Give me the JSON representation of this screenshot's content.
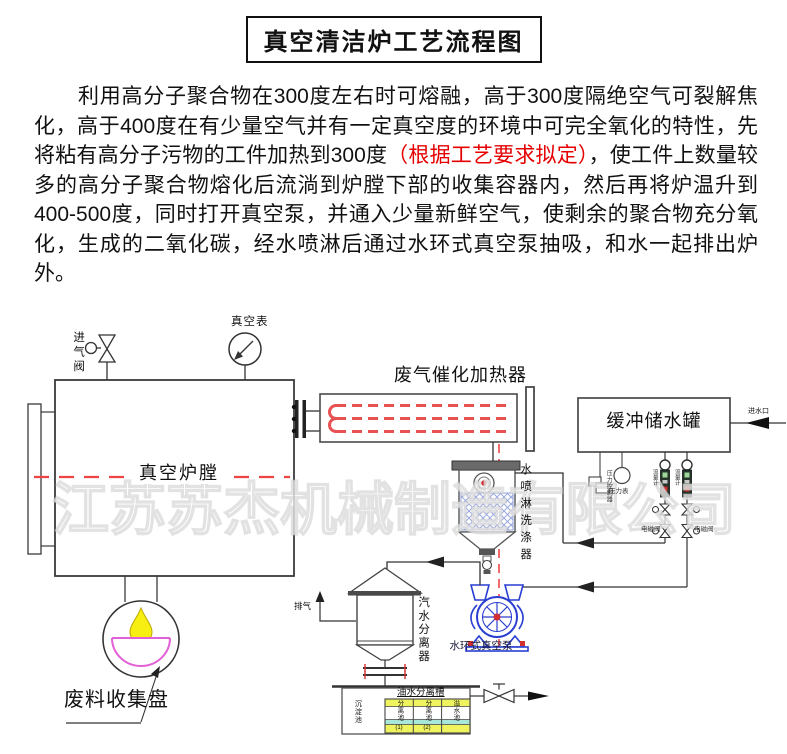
{
  "title": "真空清洁炉工艺流程图",
  "paragraph": {
    "before_red": "利用高分子聚合物在300度左右时可熔融，高于300度隔绝空气可裂解焦化，高于400度在有少量空气并有一定真空度的环境中可完全氧化的特性，先将粘有高分子污物的工件加热到300度",
    "red": "（根据工艺要求拟定）",
    "after_red": "，使工件上数量较多的高分子聚合物熔化后流淌到炉膛下部的收集容器内，然后再将炉温升到400-500度，同时打开真空泵，并通入少量新鲜空气，使剩余的聚合物充分氧化，生成的二氧化碳，经水喷淋后通过水环式真空泵抽吸，和水一起排出炉外。"
  },
  "watermark": "江苏苏杰机械制造有限公司",
  "labels": {
    "intake_valve": "进气阀",
    "vacuum_gauge": "真空表",
    "furnace_chamber": "真空炉膛",
    "catalytic_heater": "废气催化加热器",
    "buffer_tank": "缓冲储水罐",
    "water_inlet": "进水口",
    "spray_scrubber": "水喷淋洗涤器",
    "level_controller": "压力控制器",
    "pressure_gauge": "压力表",
    "flowmeter_1": "流量计",
    "flowmeter_2": "流量计",
    "solenoid_valve_1": "电磁阀",
    "solenoid_valve_2": "电磁阀",
    "steam_water_separator": "汽水分离器",
    "water_ring_pump": "水环式真空泵",
    "exhaust": "排气",
    "waste_pan": "废料收集盘"
  },
  "oil_tank": {
    "title": "油水分离槽",
    "left_cell": "沉淀池",
    "columns": [
      {
        "chars": "分离池",
        "num": "(1)"
      },
      {
        "chars": "分离池",
        "num": "(2)"
      },
      {
        "chars": "溢水池",
        "num": ""
      }
    ]
  },
  "colors": {
    "red_text": "#e60000",
    "centerline_red": "#ef4444",
    "heater_element_red": "#e85252",
    "scrubber_hatch_blue": "#93a2dd",
    "pump_blue": "#2a3ed1",
    "bowl_magenta": "#e35fd6",
    "drop_yellow": "#f7ee12",
    "table_yellow": "#eef35e",
    "table_cyan": "#a9e7d8"
  }
}
